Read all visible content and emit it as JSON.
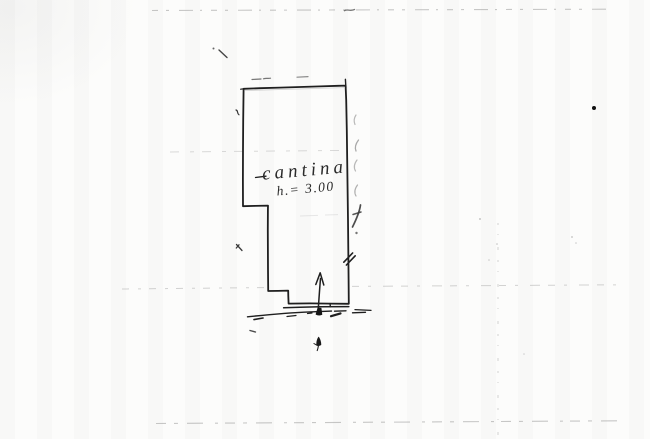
{
  "plan": {
    "room_label": "cantina",
    "room_height": "h.= 3.00"
  },
  "colors": {
    "ink": "#1f1f1f",
    "paper": "#fcfcfb",
    "faint_pencil": "#9a9a9a"
  }
}
